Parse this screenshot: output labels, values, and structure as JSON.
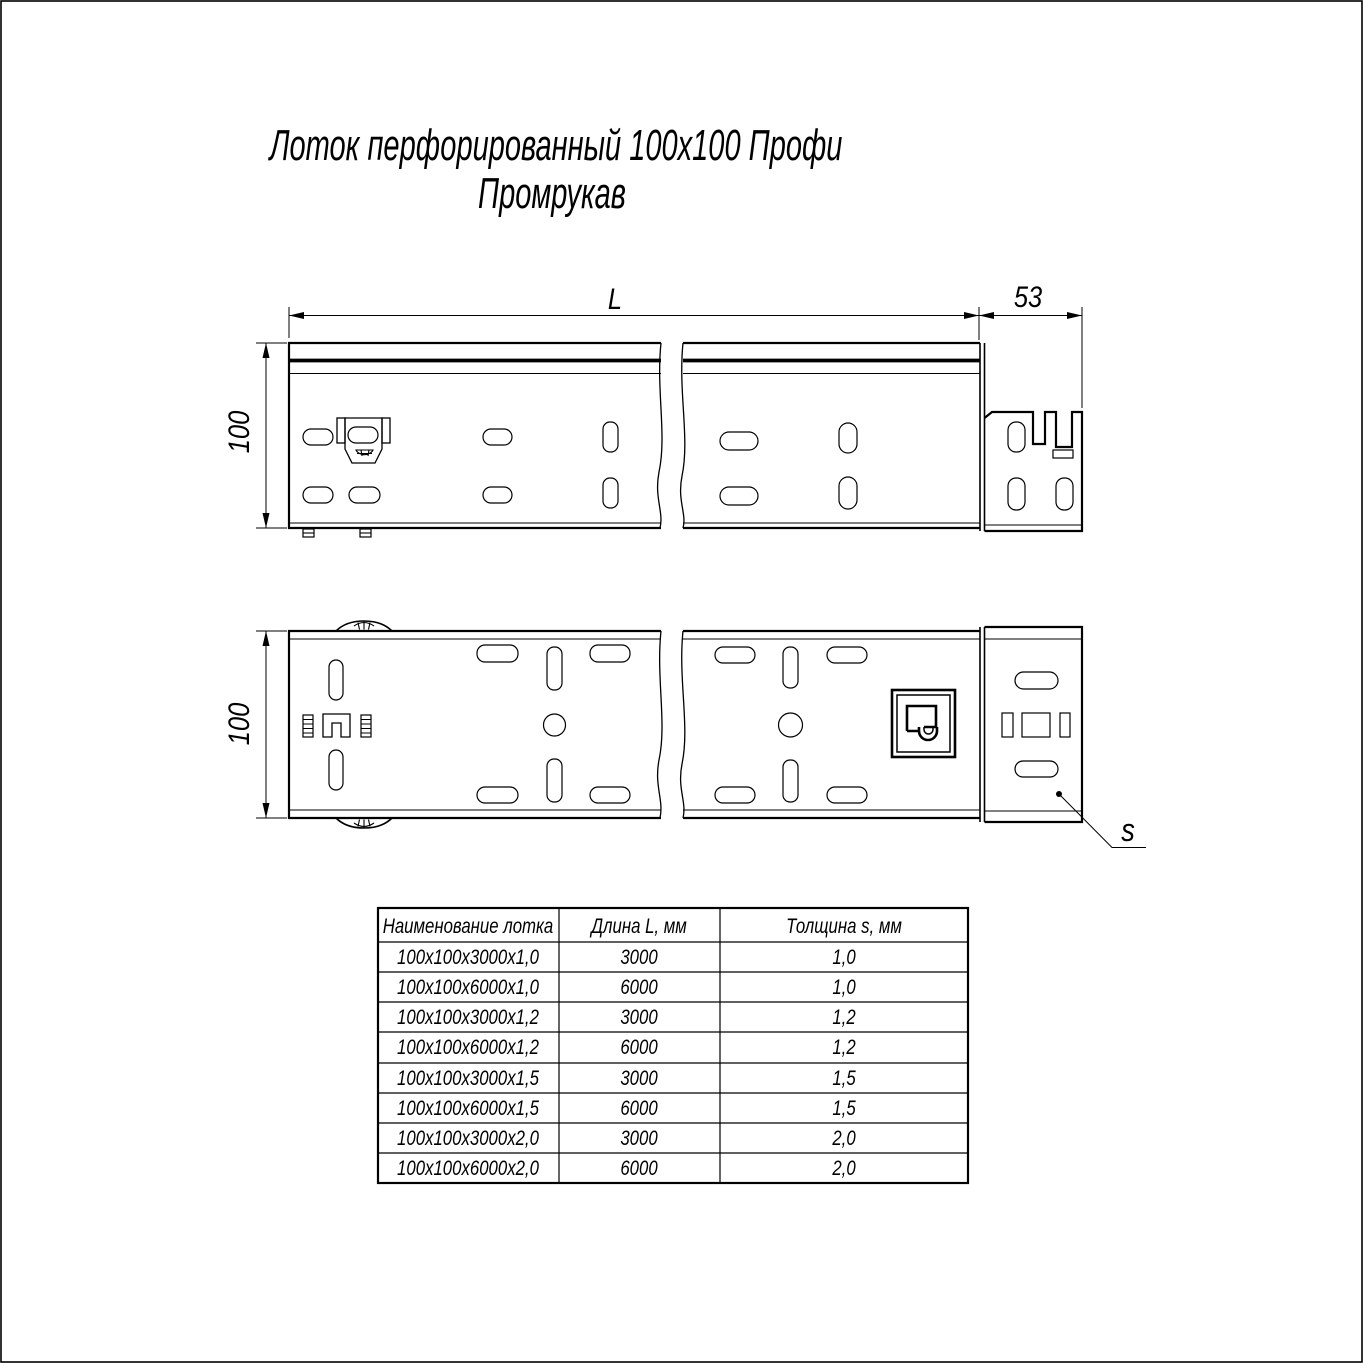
{
  "title": {
    "line1": "Лоток перфорированный 100х100 Профи",
    "line2": "Промрукав"
  },
  "dims": {
    "length": "L",
    "end_width": "53",
    "height_top": "100",
    "height_bottom": "100",
    "thickness": "s"
  },
  "table": {
    "headers": [
      "Наименование лотка",
      "Длина L, мм",
      "Толщина s, мм"
    ],
    "rows": [
      {
        "name": "100х100х3000х1,0",
        "len": "3000",
        "thk": "1,0"
      },
      {
        "name": "100х100х6000х1,0",
        "len": "6000",
        "thk": "1,0"
      },
      {
        "name": "100х100х3000х1,2",
        "len": "3000",
        "thk": "1,2"
      },
      {
        "name": "100х100х6000х1,2",
        "len": "6000",
        "thk": "1,2"
      },
      {
        "name": "100х100х3000х1,5",
        "len": "3000",
        "thk": "1,5"
      },
      {
        "name": "100х100х6000х1,5",
        "len": "6000",
        "thk": "1,5"
      },
      {
        "name": "100х100х3000х2,0",
        "len": "3000",
        "thk": "2,0"
      },
      {
        "name": "100х100х6000х2,0",
        "len": "6000",
        "thk": "2,0"
      }
    ]
  },
  "colors": {
    "line": "#000000",
    "background": "#ffffff"
  }
}
